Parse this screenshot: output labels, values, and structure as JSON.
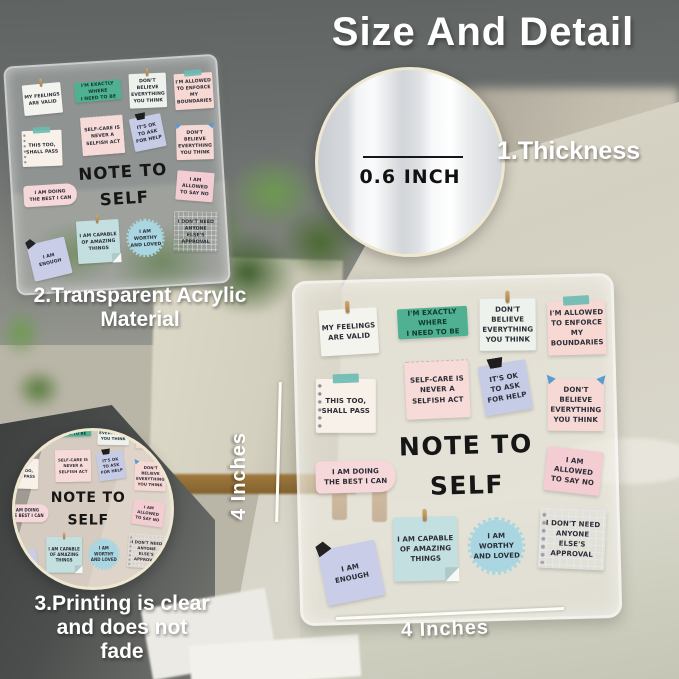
{
  "title": "Size And Detail",
  "callouts": {
    "thickness": {
      "label": "1.Thickness",
      "value": "0.6 INCH"
    },
    "material": {
      "label": "2.Transparent Acrylic\nMaterial"
    },
    "printing": {
      "label": "3.Printing is clear\nand does not\nfade"
    }
  },
  "dimensions": {
    "height": "4 Inches",
    "width": "4 Inches"
  },
  "plaque": {
    "heading_line1": "NOTE TO",
    "heading_line2": "SELF",
    "notes": [
      {
        "text": "MY FEELINGS\nARE VALID",
        "color": "#f4f4ef"
      },
      {
        "text": "I'M EXACTLY WHERE\nI NEED TO BE",
        "color": "#4fb191"
      },
      {
        "text": "DON'T BELIEVE\nEVERYTHING\nYOU THINK",
        "color": "#eef2ec"
      },
      {
        "text": "I'M ALLOWED\nTO ENFORCE\nMY BOUNDARIES",
        "color": "#f7d8d3"
      },
      {
        "text": "SELF-CARE IS\nNEVER A\nSELFISH ACT",
        "color": "#f6dbd8"
      },
      {
        "text": "IT'S OK\nTO ASK\nFOR HELP",
        "color": "#c6cbe6"
      },
      {
        "text": "THIS TOO,\nSHALL PASS",
        "color": "#f8f1ea"
      },
      {
        "text": "DON'T BELIEVE\nEVERYTHING\nYOU THINK",
        "color": "#f6d9d5"
      },
      {
        "text": "I AM DOING\nTHE BEST I CAN",
        "color": "#f6d7da"
      },
      {
        "text": "I AM ALLOWED\nTO SAY NO",
        "color": "#f4cdd2"
      },
      {
        "text": "I AM\nENOUGH",
        "color": "#c9cde8"
      },
      {
        "text": "I AM CAPABLE\nOF AMAZING\nTHINGS",
        "color": "#c3dfdf"
      },
      {
        "text": "I AM WORTHY\nAND LOVED",
        "color": "#a9d6e0"
      },
      {
        "text": "I DON'T NEED\nANYONE\nELSE'S APPROVAL",
        "color": "#fbfbfa"
      }
    ]
  },
  "colors": {
    "teal_note": "#4fb191",
    "pink_note": "#f7d8d3",
    "lavender_note": "#c9cde8",
    "blue_note": "#c3dfdf",
    "badge_blue": "#a9d6e0",
    "white_note": "#f4f4ef",
    "circle_border": "#efe8d0",
    "label_text": "#ffffff",
    "heading_text": "#161616"
  }
}
